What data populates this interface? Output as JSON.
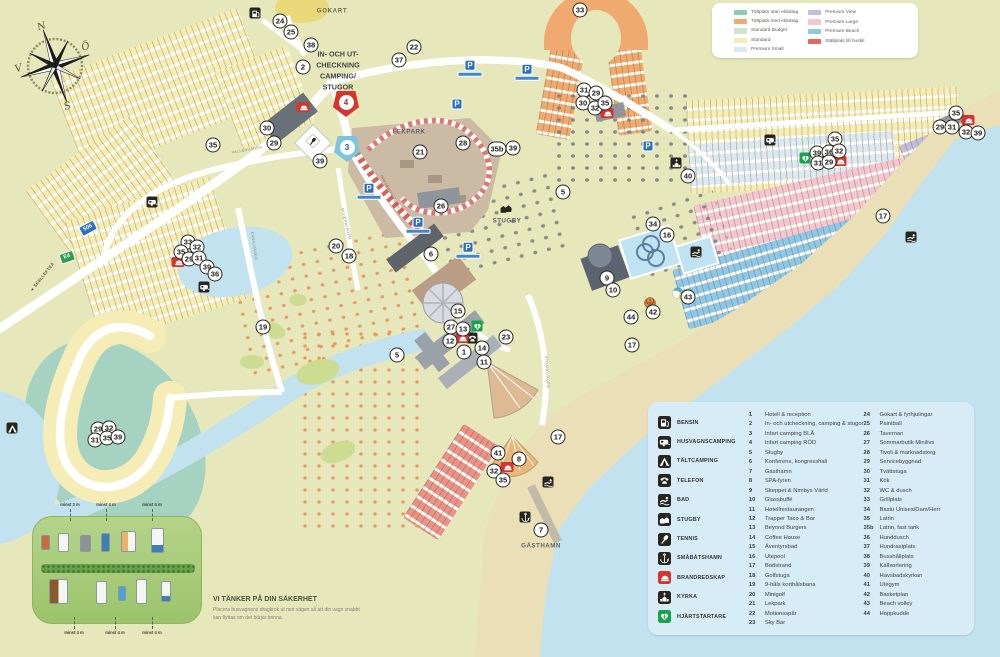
{
  "theme": {
    "land": "#e6e7ba",
    "sea": "#c2e2ef",
    "sand": "#eadfb6",
    "card": "#d8ecf8",
    "std": "#f5edb5",
    "org": "#f0a96e",
    "lav": "#c1bedd",
    "pnk": "#f3c6d0",
    "bch": "#8fc7e7",
    "psm": "#dde9f1",
    "stl": "#ea9287",
    "bud": "#cde4d2",
    "utan": "#8cc9b7"
  },
  "pitch_legend": {
    "col1": [
      {
        "label": "Tältplats utan elduttag",
        "color": "#8cc9b7"
      },
      {
        "label": "Tältplats med elduttag",
        "color": "#f0a96e"
      },
      {
        "label": "Standard Budget",
        "color": "#cde4d2"
      },
      {
        "label": "Standard",
        "color": "#f5edb5"
      },
      {
        "label": "Premium Small",
        "color": "#dde9f1"
      }
    ],
    "col2": [
      {
        "label": "Premium View",
        "color": "#c1bedd"
      },
      {
        "label": "Premium Large",
        "color": "#f3c6d0"
      },
      {
        "label": "Premium Beach",
        "color": "#8fc7e7"
      },
      {
        "label": "Ställplats till husbil",
        "color": "#e0685e"
      }
    ]
  },
  "facility_legend": {
    "icons": [
      {
        "icon": "bensin",
        "label": "BENSIN"
      },
      {
        "icon": "husvagn",
        "label": "HUSVAGNSCAMPING"
      },
      {
        "icon": "talt",
        "label": "TÄLTCAMPING"
      },
      {
        "icon": "telefon",
        "label": "TELEFON"
      },
      {
        "icon": "bad",
        "label": "BAD"
      },
      {
        "icon": "stugby",
        "label": "STUGBY"
      },
      {
        "icon": "tennis",
        "label": "TENNIS"
      },
      {
        "icon": "ankare",
        "label": "SMÅBÅTSHAMN"
      },
      {
        "icon": "brand",
        "label": "BRANDREDSKAP"
      },
      {
        "icon": "kyrka",
        "label": "KYRKA"
      },
      {
        "icon": "defib",
        "label": "HJÄRTSTARTARE"
      }
    ],
    "col1": [
      {
        "num": "1",
        "label": "Hotell & reception"
      },
      {
        "num": "2",
        "label": "In- och utcheckning, camping & stugor"
      },
      {
        "num": "3",
        "label": "Infart camping BLÅ"
      },
      {
        "num": "4",
        "label": "Infart camping RÖD"
      },
      {
        "num": "5",
        "label": "Stugby"
      },
      {
        "num": "6",
        "label": "Konferens, kongresshall"
      },
      {
        "num": "7",
        "label": "Gästhamn"
      },
      {
        "num": "8",
        "label": "SPA-fyren"
      },
      {
        "num": "9",
        "label": "Skeppet & Nimbys Värld"
      },
      {
        "num": "10",
        "label": "Glassbuffé"
      },
      {
        "num": "11",
        "label": "Hotellrestaurangen"
      },
      {
        "num": "12",
        "label": "Trapper Taco & Bar"
      },
      {
        "num": "13",
        "label": "Beyond Burgers"
      },
      {
        "num": "14",
        "label": "Coffee House"
      },
      {
        "num": "15",
        "label": "Äventyrsbad"
      },
      {
        "num": "16",
        "label": "Utepool"
      },
      {
        "num": "17",
        "label": "Badstrand"
      },
      {
        "num": "18",
        "label": "Golfstuga"
      },
      {
        "num": "19",
        "label": "9-håls korthålsbana"
      },
      {
        "num": "20",
        "label": "Minigolf"
      },
      {
        "num": "21",
        "label": "Lekpark"
      },
      {
        "num": "22",
        "label": "Motionsspår"
      },
      {
        "num": "23",
        "label": "Sky Bar"
      }
    ],
    "col2": [
      {
        "num": "24",
        "label": "Gokart & fyrhjulingar"
      },
      {
        "num": "25",
        "label": "Paintball"
      },
      {
        "num": "26",
        "label": "Tavernan"
      },
      {
        "num": "27",
        "label": "Sommarbutik Minilivs"
      },
      {
        "num": "28",
        "label": "Tivoli & marknadstorg"
      },
      {
        "num": "29",
        "label": "Servicebyggnad"
      },
      {
        "num": "30",
        "label": "Tvättstuga"
      },
      {
        "num": "31",
        "label": "Kök"
      },
      {
        "num": "32",
        "label": "WC & dusch"
      },
      {
        "num": "33",
        "label": "Grillplats"
      },
      {
        "num": "34",
        "label": "Bastu Unisex/Dam/Herr"
      },
      {
        "num": "35",
        "label": "Latrin"
      },
      {
        "num": "35b",
        "label": "Latrin, fast tank"
      },
      {
        "num": "36",
        "label": "Hunddusch"
      },
      {
        "num": "37",
        "label": "Hundrastplats"
      },
      {
        "num": "38",
        "label": "Busshållplats"
      },
      {
        "num": "39",
        "label": "Källsortering"
      },
      {
        "num": "40",
        "label": "Havsbadskyrkan"
      },
      {
        "num": "41",
        "label": "Utegym"
      },
      {
        "num": "42",
        "label": "Basketplan"
      },
      {
        "num": "43",
        "label": "Beach volley"
      },
      {
        "num": "44",
        "label": "Hoppkudde"
      }
    ]
  },
  "map": {
    "markers": [
      {
        "n": "24",
        "x": 280,
        "y": 21
      },
      {
        "n": "25",
        "x": 291,
        "y": 32
      },
      {
        "n": "38",
        "x": 311,
        "y": 45
      },
      {
        "n": "2",
        "x": 303,
        "y": 67
      },
      {
        "n": "37",
        "x": 399,
        "y": 60
      },
      {
        "n": "22",
        "x": 414,
        "y": 47
      },
      {
        "n": "33",
        "x": 580,
        "y": 10
      },
      {
        "n": "35",
        "x": 213,
        "y": 145
      },
      {
        "n": "30",
        "x": 267,
        "y": 128
      },
      {
        "n": "29",
        "x": 274,
        "y": 143
      },
      {
        "n": "39",
        "x": 320,
        "y": 161
      },
      {
        "n": "21",
        "x": 420,
        "y": 152
      },
      {
        "n": "28",
        "x": 463,
        "y": 143
      },
      {
        "n": "35b",
        "x": 497,
        "y": 149
      },
      {
        "n": "39",
        "x": 513,
        "y": 148
      },
      {
        "n": "26",
        "x": 441,
        "y": 206
      },
      {
        "n": "20",
        "x": 336,
        "y": 246
      },
      {
        "n": "18",
        "x": 349,
        "y": 256
      },
      {
        "n": "6",
        "x": 431,
        "y": 254
      },
      {
        "n": "5",
        "x": 563,
        "y": 192
      },
      {
        "n": "5",
        "x": 397,
        "y": 355
      },
      {
        "n": "15",
        "x": 458,
        "y": 311
      },
      {
        "n": "27",
        "x": 451,
        "y": 327
      },
      {
        "n": "13",
        "x": 463,
        "y": 329
      },
      {
        "n": "12",
        "x": 450,
        "y": 341
      },
      {
        "n": "1",
        "x": 464,
        "y": 352
      },
      {
        "n": "14",
        "x": 482,
        "y": 348
      },
      {
        "n": "11",
        "x": 484,
        "y": 362
      },
      {
        "n": "23",
        "x": 506,
        "y": 337
      },
      {
        "n": "9",
        "x": 607,
        "y": 278
      },
      {
        "n": "10",
        "x": 613,
        "y": 290
      },
      {
        "n": "34",
        "x": 653,
        "y": 224
      },
      {
        "n": "16",
        "x": 667,
        "y": 235
      },
      {
        "n": "44",
        "x": 631,
        "y": 317
      },
      {
        "n": "42",
        "x": 653,
        "y": 312
      },
      {
        "n": "43",
        "x": 688,
        "y": 297
      },
      {
        "n": "17",
        "x": 632,
        "y": 345
      },
      {
        "n": "17",
        "x": 558,
        "y": 437
      },
      {
        "n": "17",
        "x": 883,
        "y": 216
      },
      {
        "n": "40",
        "x": 688,
        "y": 176
      },
      {
        "n": "31",
        "x": 584,
        "y": 90
      },
      {
        "n": "29",
        "x": 596,
        "y": 93
      },
      {
        "n": "30",
        "x": 583,
        "y": 103
      },
      {
        "n": "32",
        "x": 595,
        "y": 108
      },
      {
        "n": "35",
        "x": 605,
        "y": 103
      },
      {
        "n": "35",
        "x": 835,
        "y": 139
      },
      {
        "n": "39",
        "x": 817,
        "y": 153
      },
      {
        "n": "36",
        "x": 829,
        "y": 152
      },
      {
        "n": "32",
        "x": 839,
        "y": 151
      },
      {
        "n": "31",
        "x": 818,
        "y": 163
      },
      {
        "n": "29",
        "x": 829,
        "y": 162
      },
      {
        "n": "35",
        "x": 956,
        "y": 113
      },
      {
        "n": "29",
        "x": 940,
        "y": 127
      },
      {
        "n": "31",
        "x": 952,
        "y": 127
      },
      {
        "n": "32",
        "x": 966,
        "y": 132
      },
      {
        "n": "39",
        "x": 978,
        "y": 133
      },
      {
        "n": "33",
        "x": 188,
        "y": 242
      },
      {
        "n": "35",
        "x": 181,
        "y": 252
      },
      {
        "n": "32",
        "x": 197,
        "y": 247
      },
      {
        "n": "29",
        "x": 189,
        "y": 259
      },
      {
        "n": "31",
        "x": 199,
        "y": 258
      },
      {
        "n": "39",
        "x": 207,
        "y": 267
      },
      {
        "n": "36",
        "x": 215,
        "y": 274
      },
      {
        "n": "19",
        "x": 263,
        "y": 327
      },
      {
        "n": "29",
        "x": 98,
        "y": 429
      },
      {
        "n": "32",
        "x": 109,
        "y": 428
      },
      {
        "n": "31",
        "x": 95,
        "y": 440
      },
      {
        "n": "35",
        "x": 107,
        "y": 438
      },
      {
        "n": "39",
        "x": 118,
        "y": 437
      },
      {
        "n": "41",
        "x": 498,
        "y": 453
      },
      {
        "n": "8",
        "x": 519,
        "y": 459
      },
      {
        "n": "32",
        "x": 494,
        "y": 471
      },
      {
        "n": "35",
        "x": 503,
        "y": 480
      },
      {
        "n": "7",
        "x": 541,
        "y": 530
      }
    ],
    "entrances": [
      {
        "n": "3",
        "x": 347,
        "y": 149,
        "color": "#7cc4e0",
        "text": "#1b5e84"
      },
      {
        "n": "4",
        "x": 346,
        "y": 104,
        "color": "#d6352e",
        "text": "#b8241e"
      }
    ],
    "icons": [
      {
        "t": "bensin",
        "x": 255,
        "y": 13
      },
      {
        "t": "husvagn",
        "x": 152,
        "y": 202
      },
      {
        "t": "husvagn",
        "x": 204,
        "y": 287
      },
      {
        "t": "husvagn",
        "x": 770,
        "y": 140
      },
      {
        "t": "talt",
        "x": 12,
        "y": 428
      },
      {
        "t": "tennism",
        "x": 313,
        "y": 141
      },
      {
        "t": "kyrka",
        "x": 676,
        "y": 163
      },
      {
        "t": "ankare",
        "x": 525,
        "y": 517
      },
      {
        "t": "bad",
        "x": 548,
        "y": 482
      },
      {
        "t": "bad",
        "x": 911,
        "y": 237
      },
      {
        "t": "bad",
        "x": 696,
        "y": 252
      },
      {
        "t": "telefon",
        "x": 472,
        "y": 338
      },
      {
        "t": "stugam",
        "x": 506,
        "y": 208
      },
      {
        "t": "brand",
        "x": 303,
        "y": 107
      },
      {
        "t": "brand",
        "x": 178,
        "y": 262
      },
      {
        "t": "brand",
        "x": 607,
        "y": 113
      },
      {
        "t": "brand",
        "x": 840,
        "y": 161
      },
      {
        "t": "brand",
        "x": 968,
        "y": 120
      },
      {
        "t": "brand",
        "x": 507,
        "y": 467
      },
      {
        "t": "brand",
        "x": 462,
        "y": 338
      },
      {
        "t": "defib",
        "x": 477,
        "y": 326
      },
      {
        "t": "defib",
        "x": 805,
        "y": 158
      },
      {
        "t": "basket",
        "x": 650,
        "y": 303
      },
      {
        "t": "boll",
        "x": 678,
        "y": 293
      }
    ],
    "parking": [
      {
        "x": 470,
        "y": 68,
        "bar": true
      },
      {
        "x": 527,
        "y": 72,
        "bar": true
      },
      {
        "x": 457,
        "y": 104,
        "bar": false
      },
      {
        "x": 369,
        "y": 191,
        "bar": true
      },
      {
        "x": 418,
        "y": 225,
        "bar": true
      },
      {
        "x": 648,
        "y": 146,
        "bar": false
      },
      {
        "x": 468,
        "y": 250,
        "bar": true
      }
    ],
    "labels": [
      {
        "t": "GOKART",
        "x": 332,
        "y": 11,
        "s": 6.2,
        "c": "#6a6e54",
        "w": 700,
        "r": 0,
        "ls": 0.6
      },
      {
        "t": "IN- OCH UT-",
        "x": 338,
        "y": 54,
        "s": 7.2,
        "c": "#41464b",
        "w": 700,
        "r": 0,
        "ls": 0
      },
      {
        "t": "CHECKNING",
        "x": 338,
        "y": 65,
        "s": 7.2,
        "c": "#41464b",
        "w": 700,
        "r": 0,
        "ls": 0
      },
      {
        "t": "CAMPING/",
        "x": 338,
        "y": 76,
        "s": 7.2,
        "c": "#41464b",
        "w": 700,
        "r": 0,
        "ls": 0
      },
      {
        "t": "STUGOR",
        "x": 338,
        "y": 87,
        "s": 7.2,
        "c": "#41464b",
        "w": 700,
        "r": 0,
        "ls": 0
      },
      {
        "t": "LEKPARK",
        "x": 409,
        "y": 132,
        "s": 6.2,
        "c": "#5f646a",
        "w": 700,
        "r": 0,
        "ls": 0.5
      },
      {
        "t": "STUGBY",
        "x": 507,
        "y": 221,
        "s": 6.2,
        "c": "#5f646a",
        "w": 700,
        "r": 0,
        "ls": 0.5
      },
      {
        "t": "GÄSTHAMN",
        "x": 541,
        "y": 546,
        "s": 6.2,
        "c": "#5f646a",
        "w": 700,
        "r": 0,
        "ls": 0.5
      },
      {
        "t": "VALLENVÄGEN",
        "x": 247,
        "y": 150,
        "s": 3.8,
        "c": "#8a8a7a",
        "w": 400,
        "r": -10,
        "ls": 0.3
      },
      {
        "t": "KANALVÄGEN",
        "x": 254,
        "y": 246,
        "s": 3.8,
        "c": "#8a8a7a",
        "w": 400,
        "r": 82,
        "ls": 0.3
      },
      {
        "t": "STRANDVÄGEN",
        "x": 547,
        "y": 372,
        "s": 3.8,
        "c": "#8a8a7a",
        "w": 400,
        "r": 86,
        "ls": 0.3
      },
      {
        "t": "RIVIERAVÄGEN",
        "x": 346,
        "y": 224,
        "s": 3.8,
        "c": "#8a8a7a",
        "w": 400,
        "r": 76,
        "ls": 0.3
      },
      {
        "t": "HAVSBADSVÄGEN",
        "x": 390,
        "y": 192,
        "s": 3.8,
        "c": "#a05a52",
        "w": 400,
        "r": 62,
        "ls": 0.3
      },
      {
        "t": "◄ SKELLEFTEÅ",
        "x": 42,
        "y": 277,
        "s": 4.2,
        "c": "#55554a",
        "w": 700,
        "r": -51,
        "ls": 0.3
      }
    ],
    "road_signs": [
      {
        "t": "506",
        "x": 88,
        "y": 228,
        "bg": "#2f6fbe",
        "r": -28
      },
      {
        "t": "E4",
        "x": 67,
        "y": 257,
        "bg": "#2e9e4f",
        "r": -18
      }
    ],
    "compass_letters": {
      "n": "N",
      "e": "Ö",
      "s": "S",
      "w": "V"
    }
  },
  "safety": {
    "heading": "VI TÄNKER PÅ DIN SÄKERHET",
    "body": "Placera husvagnens dragkrok ut mot vägen så att din vagn snabbt kan flyttas om det börjar brinna.",
    "top_distances": [
      {
        "t": "minst 3 m",
        "x": 70
      },
      {
        "t": "minst 4 m",
        "x": 106
      },
      {
        "t": "minst 4 m",
        "x": 152
      }
    ],
    "bottom_distances": [
      {
        "t": "minst 4 m",
        "x": 74
      },
      {
        "t": "minst 4 m",
        "x": 115
      },
      {
        "t": "minst 4 m",
        "x": 152
      }
    ]
  }
}
